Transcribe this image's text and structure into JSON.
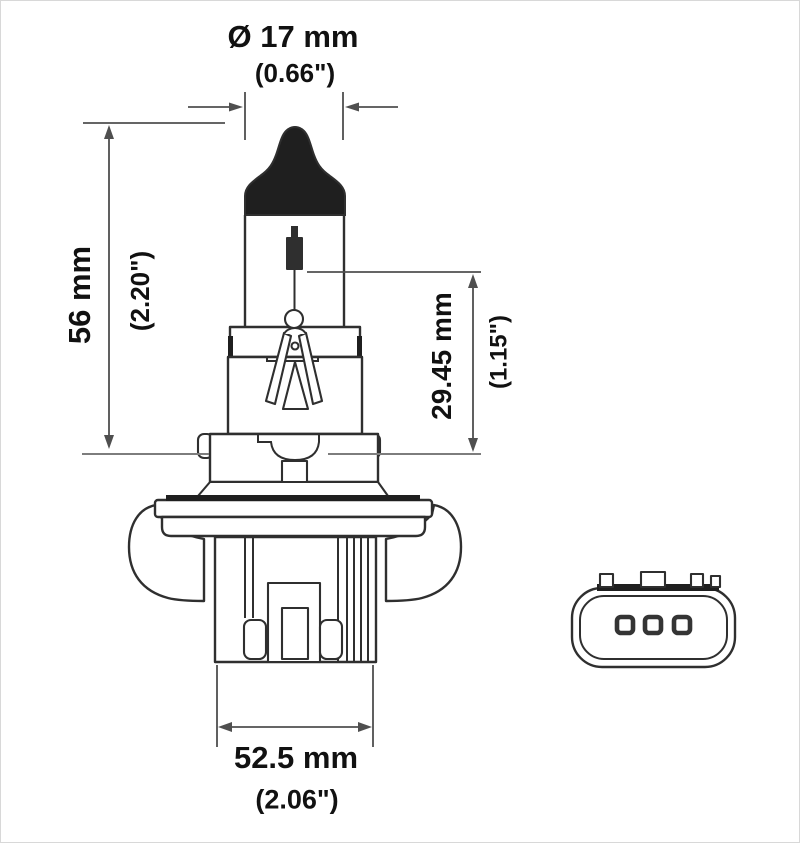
{
  "diagram": {
    "description": "technical dimension drawing of halogen bulb with end-view of tri-terminal connector",
    "dimensions": {
      "diameter": {
        "metric": "Ø 17 mm",
        "imperial": "(0.66\")"
      },
      "overall_length": {
        "metric": "56 mm",
        "imperial": "(2.20\")"
      },
      "filament_height": {
        "metric": "29.45 mm",
        "imperial": "(1.15\")"
      },
      "base_width": {
        "metric": "52.5 mm",
        "imperial": "(2.06\")"
      }
    },
    "colors": {
      "line": "#2f2f2f",
      "dimension_line": "#4f4f4f",
      "extension_line": "#7d7d7d",
      "fill_dark": "#1f1f1f",
      "text": "#111111",
      "background": "#ffffff"
    }
  }
}
